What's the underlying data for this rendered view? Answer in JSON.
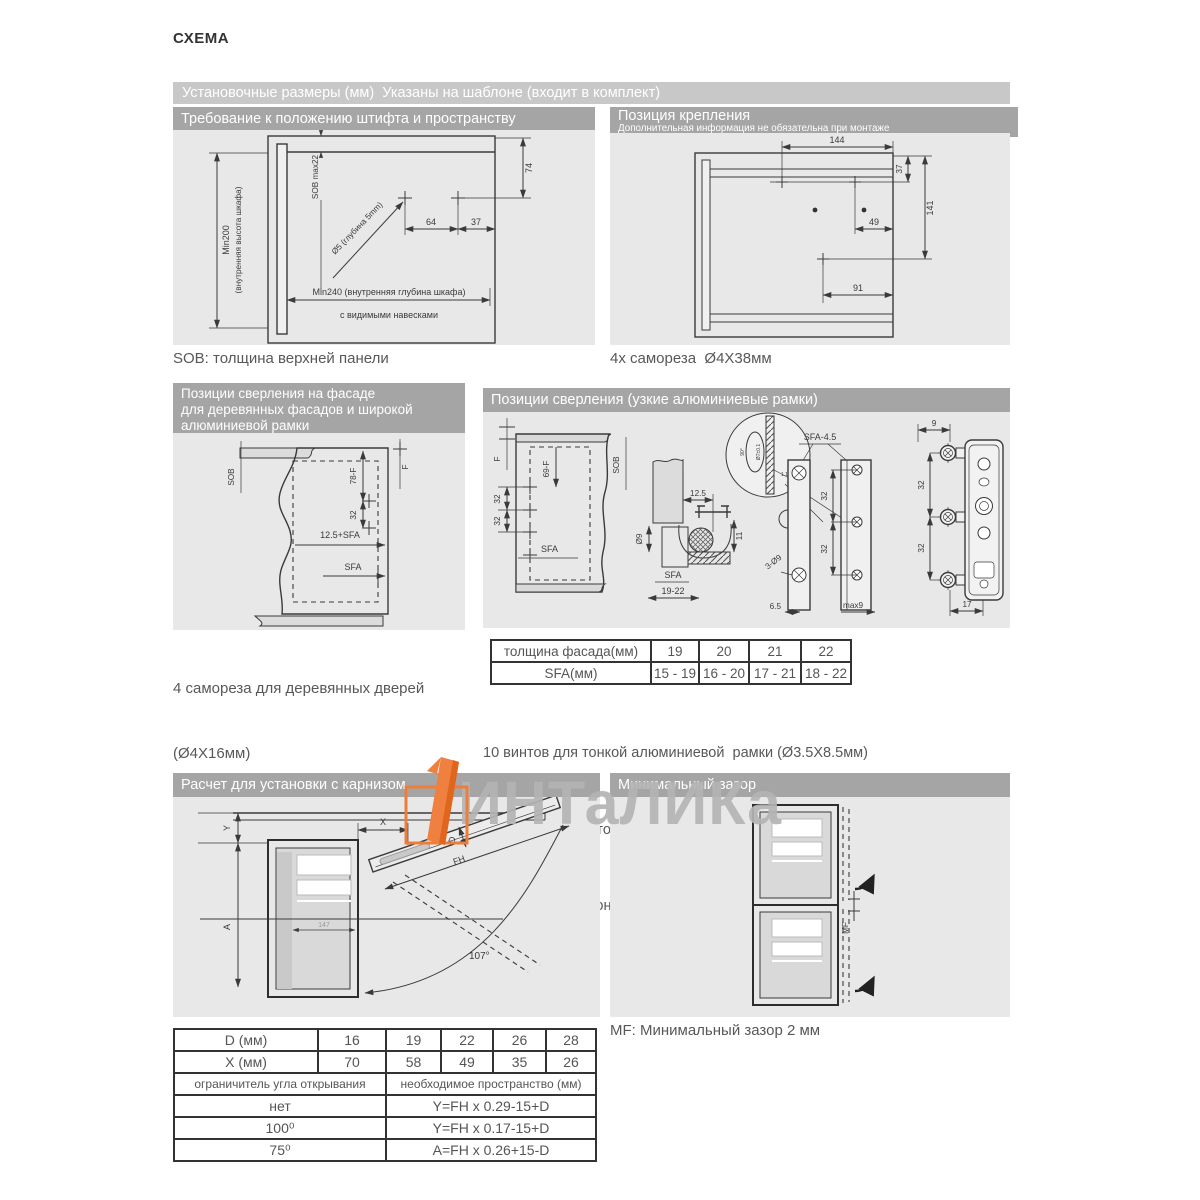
{
  "title": "СХЕМА",
  "top_banner": "Установочные размеры (мм)  Указаны на шаблоне (входит в комплект)",
  "watermark": {
    "text": "ИНТаЛИКа"
  },
  "pin_section": {
    "header": "Требование к положению штифта и пространству",
    "caption": "SOB: толщина верхней панели",
    "labels": {
      "min200": "Min200",
      "inner_height": "(внутренняя высота шкафа)",
      "sob_max": "SOB max22",
      "drill": "Ø5 (глубина 5mm)",
      "d64": "64",
      "d37": "37",
      "d74": "74",
      "min240": "Min240 (внутренняя глубина шкафа)",
      "hinges": "с видимыми навесками"
    }
  },
  "mount_section": {
    "header": "Позиция крепления",
    "subheader": "Дополнительная информация не обязательна при монтаже",
    "caption": "4x самореза  Ø4X38мм",
    "labels": {
      "d144": "144",
      "d37": "37",
      "d141": "141",
      "d49": "49",
      "d91": "91"
    }
  },
  "wood_section": {
    "header_lines": [
      "Позиции сверления на фасаде",
      "для деревянных фасадов и широкой",
      "алюминиевой рамки"
    ],
    "captions": [
      "4 самореза для деревянных дверей",
      "(Ø4X16мм)",
      "SFA: боковое наложение фасада",
      "F: зазор"
    ],
    "labels": {
      "sob": "SOB",
      "d78f": "78-F",
      "f": "F",
      "d32": "32",
      "sfa125": "12.5+SFA",
      "sfa": "SFA"
    }
  },
  "alu_section": {
    "header": "Позиции сверления (узкие алюминиевые рамки)",
    "labels": {
      "f": "F",
      "d69f": "69-F",
      "sob": "SOB",
      "d32a": "32",
      "d32b": "32",
      "sfa_a": "SFA",
      "d125": "12.5",
      "d9": "Ø9",
      "d11": "11",
      "sfa_b": "SFA",
      "d1922": "19-22",
      "deg90": "90°",
      "d7": "Ø7±0.1",
      "deg11": "1.1°",
      "sfa45": "SFA-4.5",
      "d32c": "32",
      "d32d": "32",
      "d3o9": "3-Ø9",
      "d65": "6.5",
      "max9": "max9",
      "d9t": "9",
      "d32e": "32",
      "d32f": "32",
      "d17": "17"
    },
    "table": {
      "rows": [
        {
          "label": "толщина фасада(мм)",
          "values": [
            "19",
            "20",
            "21",
            "22"
          ]
        },
        {
          "label": "SFA(мм)",
          "values": [
            "15 - 19",
            "16 - 20",
            "17 - 21",
            "18 - 22"
          ]
        }
      ]
    },
    "notes": [
      "10 винтов для тонкой алюминиевой  рамки (Ø3.5X8.5мм)",
      "*При изменении толщины материала, измените установочные размеры",
      "Крепление для тонкой алюминиевой рамки заказывается отдельно"
    ]
  },
  "cornice_section": {
    "header": "Расчет для установки с карнизом",
    "labels": {
      "y": "Y",
      "x": "X",
      "d": "D",
      "fh": "FH",
      "a": "A",
      "angle": "107°",
      "inner": "147"
    }
  },
  "gap_section": {
    "header": "Минимальный зазор",
    "caption": "MF: Минимальный зазор 2 мм",
    "labels": {
      "mf": "MF"
    }
  },
  "calc_table": {
    "dim_rows": [
      {
        "label": "D (мм)",
        "values": [
          "16",
          "19",
          "22",
          "26",
          "28"
        ]
      },
      {
        "label": "X (мм)",
        "values": [
          "70",
          "58",
          "49",
          "35",
          "26"
        ]
      }
    ],
    "split_header": {
      "left": "ограничитель угла открывания",
      "right": "необходимое пространство (мм)"
    },
    "formula_rows": [
      {
        "left": "нет",
        "right": "Y=FH x 0.29-15+D"
      },
      {
        "left": "100⁰",
        "right": "Y=FH x 0.17-15+D"
      },
      {
        "left": "75⁰",
        "right": "A=FH x 0.26+15-D"
      }
    ]
  }
}
